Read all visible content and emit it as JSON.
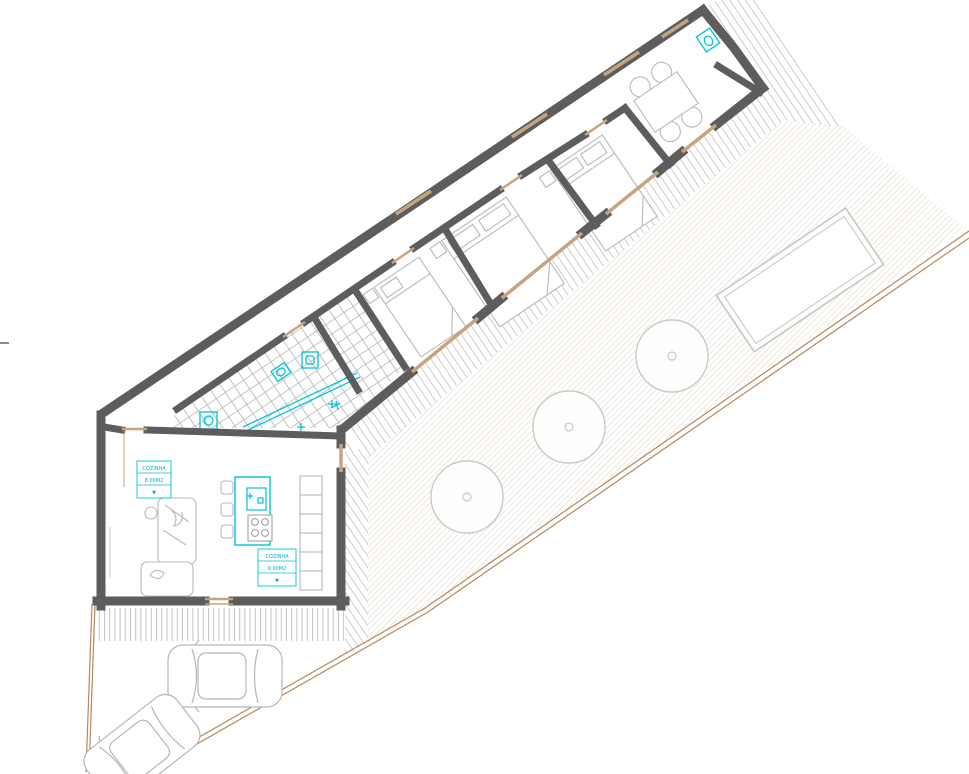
{
  "labels": {
    "kitchen_small": {
      "line1": "COZINHA",
      "line2": "8.00M2",
      "line3": "▼"
    },
    "kitchen_main": {
      "line1": "COZINHA",
      "line2": "9.00M2",
      "line3": "▼"
    }
  },
  "scene": {
    "type": "architectural floor plan, top view",
    "bedroom_count": 3,
    "tree_count": 3,
    "car_count": 2,
    "pool_count": 1
  },
  "colors": {
    "wall": "#5d5d5d",
    "fixture_cyan": "#00c3d6",
    "boundary_tan": "#b5885e",
    "glazing_tan": "#c8a47e",
    "furniture_gray": "#b9b9b9",
    "deck_stripe": "#cbcbcb",
    "yard_hatch": "#ded5c4",
    "tile_line": "#b3b3b3"
  }
}
